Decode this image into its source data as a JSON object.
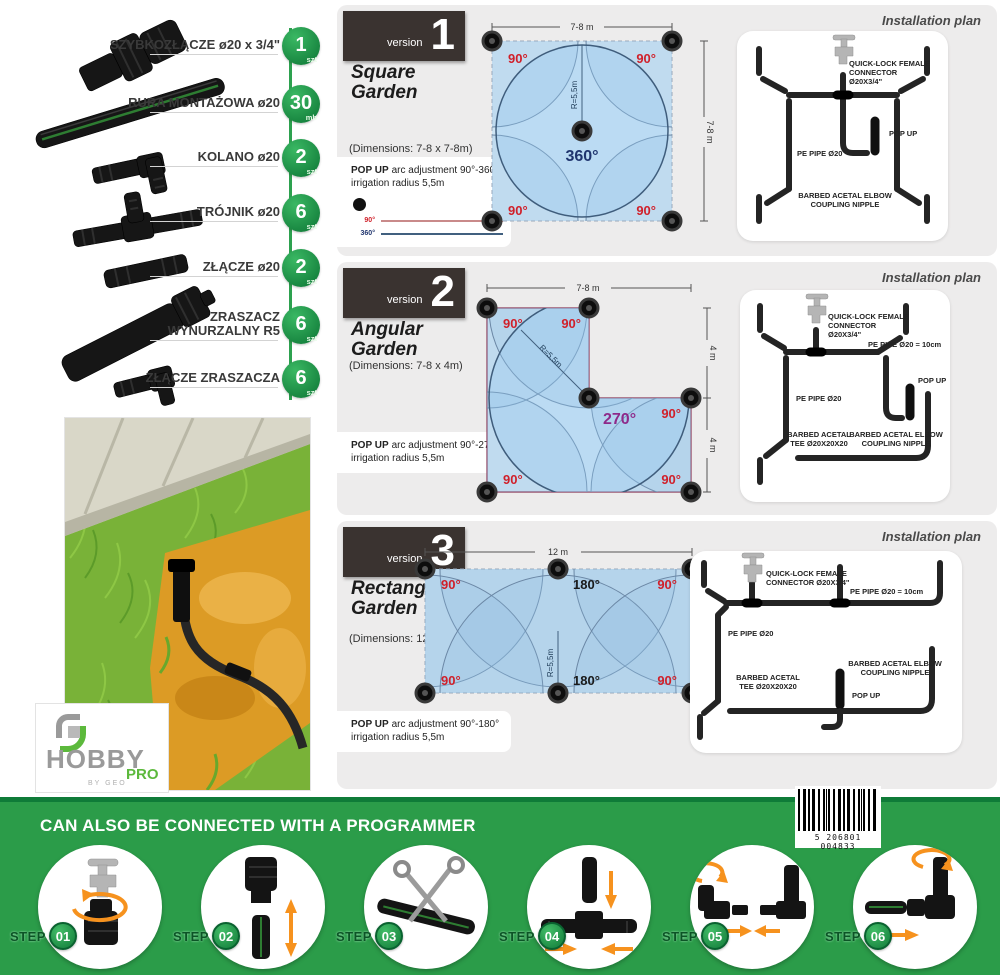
{
  "parts": {
    "items": [
      {
        "name": "SZYBKOZŁĄCZE ø20 x 3/4\"",
        "qty": "1",
        "unit": "szt"
      },
      {
        "name": "RURA MONTAŻOWA ø20",
        "qty": "30",
        "unit": "mb"
      },
      {
        "name": "KOLANO ø20",
        "qty": "2",
        "unit": "szt"
      },
      {
        "name": "TRÓJNIK ø20",
        "qty": "6",
        "unit": "szt"
      },
      {
        "name": "ZŁĄCZE ø20",
        "qty": "2",
        "unit": "szt"
      },
      {
        "name": "ZRASZACZ WYNURZALNY R5",
        "qty": "6",
        "unit": "szt"
      },
      {
        "name": "ZŁĄCZE ZRASZACZA",
        "qty": "6",
        "unit": "szt"
      }
    ]
  },
  "logo": {
    "brand": "HOBBY",
    "sub": "PRO",
    "byline": "BY GEO"
  },
  "versions": [
    {
      "badge_word": "version",
      "number": "1",
      "name_line1": "Square",
      "name_line2": "Garden",
      "dimensions": "(Dimensions: 7-8 x 7-8m)",
      "popup_bold": "POP UP",
      "popup_text": "arc adjustment 90°-360°",
      "popup_line2": "irrigation radius 5,5m",
      "legend": [
        {
          "label": "90°"
        },
        {
          "label": "360°"
        }
      ],
      "diagram": {
        "top_dim": "7-8 m",
        "right_dim": "7-8 m",
        "radius": "R=5,5m",
        "angle_tl": "90°",
        "angle_tr": "90°",
        "angle_bl": "90°",
        "angle_br": "90°",
        "angle_center": "360°"
      },
      "plan": {
        "title": "Installation plan",
        "quick_lock": "QUICK-LOCK FEMALE CONNECTOR Ø20X3/4\"",
        "pop_up": "POP UP",
        "pe_pipe": "PE PIPE Ø20",
        "elbow": "BARBED ACETAL ELBOW COUPLING NIPPLE"
      }
    },
    {
      "badge_word": "version",
      "number": "2",
      "name_line1": "Angular",
      "name_line2": "Garden",
      "dimensions": "(Dimensions: 7-8 x 4m)",
      "popup_bold": "POP UP",
      "popup_text": "arc adjustment 90°-270°",
      "popup_line2": "irrigation radius 5,5m",
      "diagram": {
        "top_dim": "7-8 m",
        "right_dim_upper": "4 m",
        "right_dim_lower": "4 m",
        "radius": "R=5,5m",
        "angle_tl": "90°",
        "angle_tm": "90°",
        "angle_center": "270°",
        "angle_mr": "90°",
        "angle_bl": "90°",
        "angle_br": "90°"
      },
      "plan": {
        "title": "Installation plan",
        "quick_lock": "QUICK-LOCK FEMALE CONNECTOR Ø20X3/4\"",
        "pe_pipe_10": "PE PIPE Ø20 = 10cm",
        "pop_up": "POP UP",
        "pe_pipe": "PE PIPE Ø20",
        "tee": "BARBED ACETAL TEE Ø20X20X20",
        "elbow": "BARBED ACETAL ELBOW COUPLING NIPPLE"
      }
    },
    {
      "badge_word": "version",
      "number": "3",
      "name_line1": "Rectangular",
      "name_line2": "Garden",
      "dimensions": "(Dimensions: 12 x 6m)",
      "popup_bold": "POP UP",
      "popup_text": "arc adjustment 90°-180°",
      "popup_line2": "irrigation radius 5,5m",
      "diagram": {
        "top_dim": "12 m",
        "right_dim": "6 m",
        "radius": "R=5,5m",
        "angle_tl": "90°",
        "angle_tm": "180°",
        "angle_tr": "90°",
        "angle_bl": "90°",
        "angle_bm": "180°",
        "angle_br": "90°"
      },
      "plan": {
        "title": "Installation plan",
        "quick_lock": "QUICK-LOCK FEMALE CONNECTOR Ø20X3/4\"",
        "pe_pipe_10": "PE PIPE Ø20 = 10cm",
        "pop_up": "POP UP",
        "pe_pipe": "PE PIPE Ø20",
        "tee": "BARBED ACETAL TEE Ø20X20X20",
        "elbow": "BARBED ACETAL ELBOW COUPLING NIPPLE"
      }
    }
  ],
  "banner": {
    "title": "CAN ALSO BE CONNECTED WITH A PROGRAMMER",
    "barcode_digits": "5 206801 004833",
    "steps": [
      {
        "label": "STEP",
        "number": "01"
      },
      {
        "label": "STEP",
        "number": "02"
      },
      {
        "label": "STEP",
        "number": "03"
      },
      {
        "label": "STEP",
        "number": "04"
      },
      {
        "label": "STEP",
        "number": "05"
      },
      {
        "label": "STEP",
        "number": "06"
      }
    ]
  },
  "colors": {
    "banner_green": "#2b9c49",
    "banner_edge": "#0f7b38",
    "badge_green": "#2fae55",
    "badge_green_dark": "#0c7434",
    "version_badge_bg": "#3a3330",
    "panel_bg": "#edecec",
    "diagram_fill": "#cfe5f4",
    "angle_red": "#d0202a",
    "angle_navy": "#20356e",
    "angle_purple": "#8e2a8a",
    "arrow_orange": "#f6921e",
    "logo_green": "#5cb93c",
    "logo_gray": "#9a9a9a"
  }
}
